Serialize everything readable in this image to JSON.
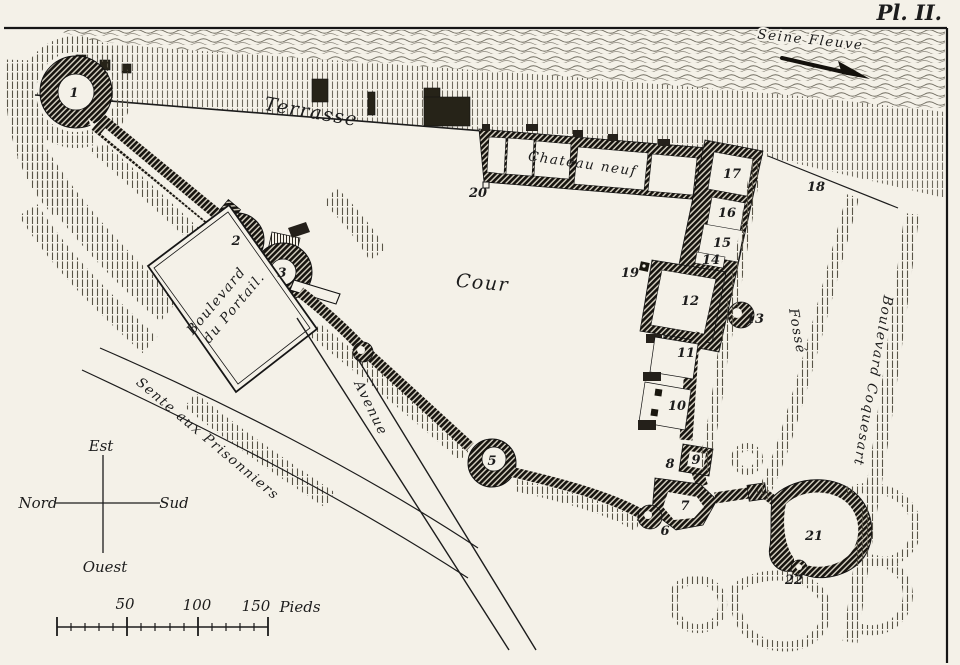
{
  "plate_label": "Pl. II.",
  "colors": {
    "paper": "#f4f1e8",
    "ink": "#1c1c1c"
  },
  "labels": {
    "river": "Seine Fleuve",
    "terrace": "Terrasse",
    "new_chateau": "Chateau neuf",
    "courtyard": "Cour",
    "boulevard_portail_l1": "Boulevard",
    "boulevard_portail_l2": "du Portail.",
    "avenue": "Avenue",
    "prisoners_path": "Sente aux Prisonniers",
    "moat": "Fossé",
    "outer_boulevard": "Boulevard Coquesart"
  },
  "compass": {
    "east": "Est",
    "north": "Nord",
    "south": "Sud",
    "west": "Ouest"
  },
  "scale_bar": {
    "tick_50": "50",
    "tick_100": "100",
    "tick_150": "150",
    "unit": "Pieds"
  },
  "markers": [
    {
      "label": "1"
    },
    {
      "label": "2"
    },
    {
      "label": "3"
    },
    {
      "label": "5"
    },
    {
      "label": "6"
    },
    {
      "label": "7"
    },
    {
      "label": "8"
    },
    {
      "label": "9"
    },
    {
      "label": "10"
    },
    {
      "label": "11"
    },
    {
      "label": "12"
    },
    {
      "label": "13"
    },
    {
      "label": "14"
    },
    {
      "label": "15"
    },
    {
      "label": "16"
    },
    {
      "label": "17"
    },
    {
      "label": "18"
    },
    {
      "label": "19"
    },
    {
      "label": "20"
    },
    {
      "label": "21"
    },
    {
      "label": "22"
    }
  ]
}
